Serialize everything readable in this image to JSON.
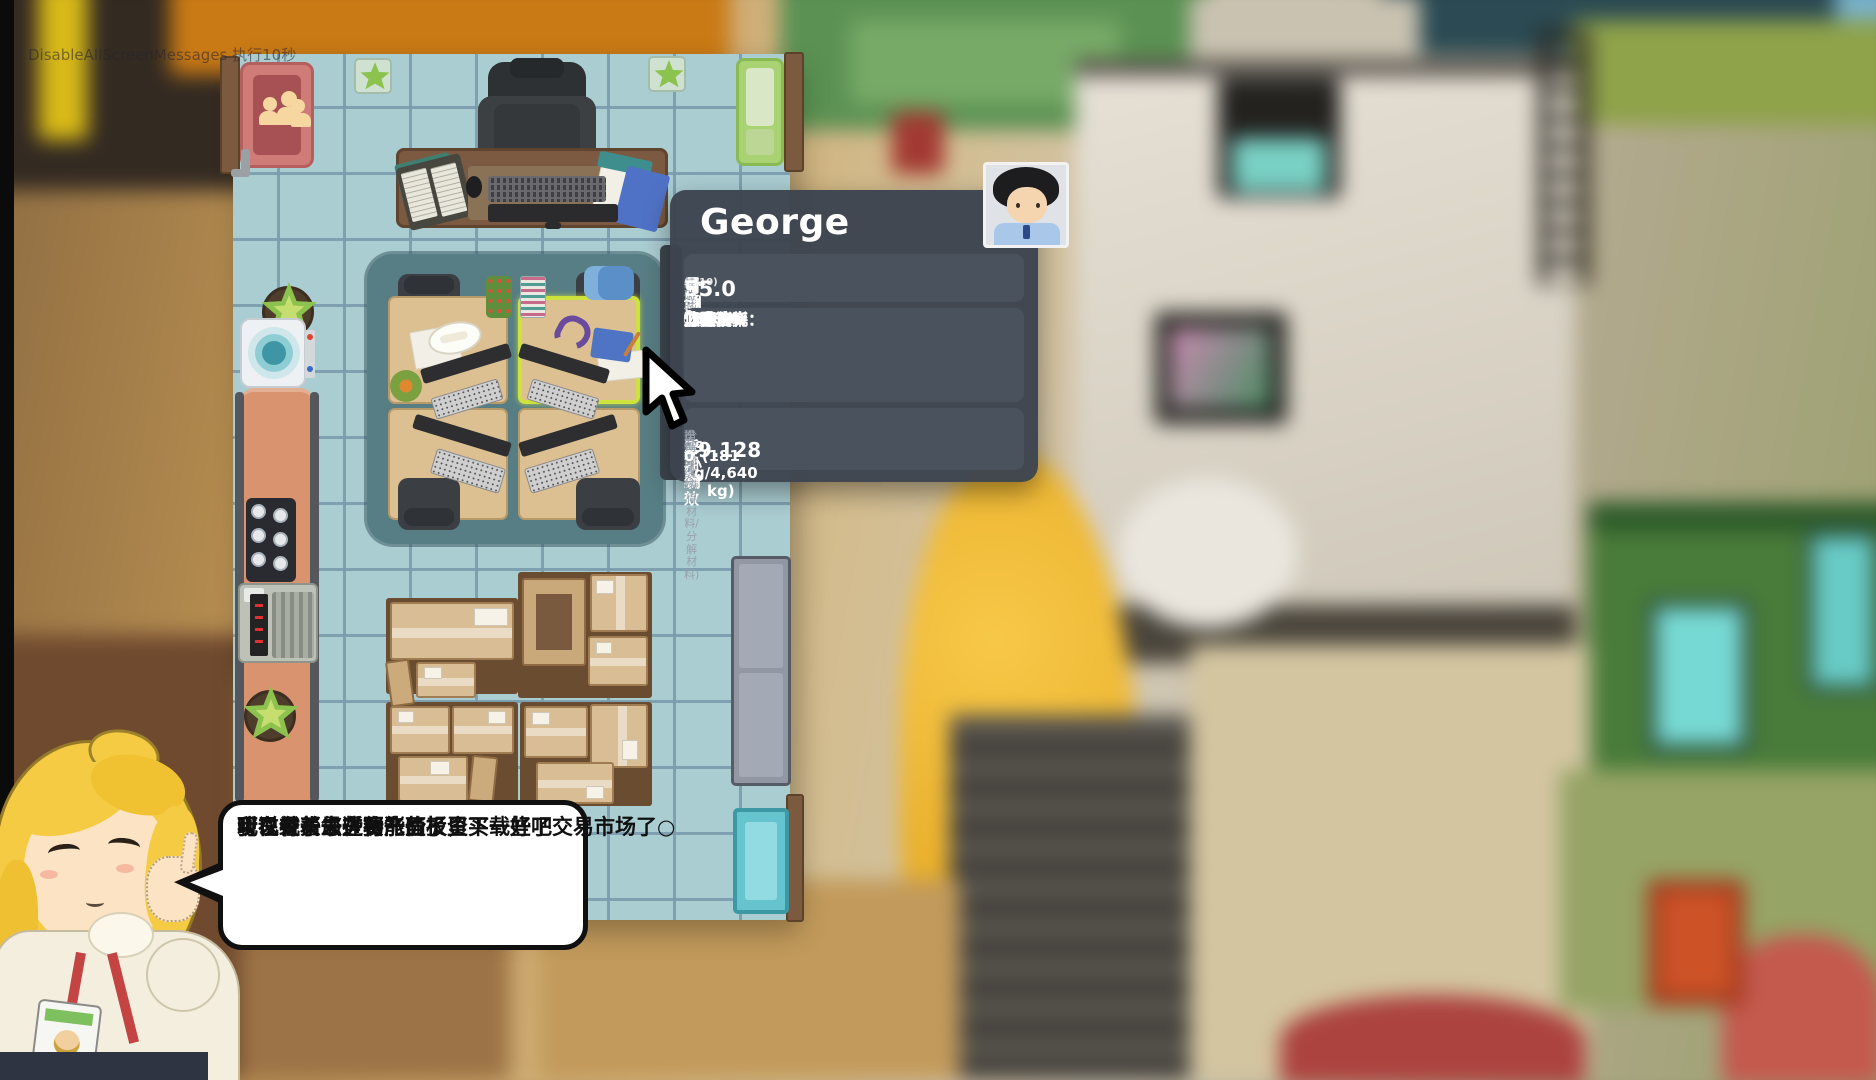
{
  "debug_text": "DisableAllScreenMessages 执行10秒",
  "character_panel": {
    "name": "George",
    "info": {
      "department_label": "部门",
      "department": "骨刨部",
      "level_label": "级别",
      "level": "普通员工",
      "level_progress": "(7/10)",
      "base_wage_label": "基础时薪",
      "base_wage": "55.0"
    },
    "stats": {
      "left": [
        {
          "icon": "luck-icon",
          "glyph": "♣",
          "label": "幸运：",
          "value": "15.0%"
        },
        {
          "icon": "favor-icon",
          "glyph": "♥",
          "label": "好感度：",
          "value": "5%"
        },
        {
          "icon": "overtime-pay-icon",
          "glyph": "♦",
          "label": "加班工资：",
          "value": "110.0"
        },
        {
          "icon": "exp-multiplier-icon",
          "glyph": "★",
          "label": "经验倍率：",
          "value": "7.2"
        }
      ],
      "right": [
        {
          "icon": "strength-icon",
          "glyph": "♠",
          "label": "力量：",
          "value": "80.0"
        },
        {
          "icon": "speed-icon",
          "glyph": "▶",
          "label": "速度：",
          "value": "8.0"
        },
        {
          "icon": "skill-icon",
          "glyph": "✓",
          "label": "技巧：",
          "value": "60.0%"
        },
        {
          "icon": "stamina-cost-icon",
          "glyph": "●",
          "label": "体力消耗：",
          "value": "10.0"
        }
      ]
    },
    "performance": {
      "recent_label": "近期绩效",
      "work_hours_label": "工作时长",
      "work_hours": "29 小时",
      "overall_label": "综合评分",
      "overall": "49.128",
      "slack_label": "摸鱼次数",
      "slack": "0",
      "decompose_label": "分解绩效(获得材料/分解材料)",
      "decompose": "(181 kg/4,640 kg)",
      "build_label": "建设实绩",
      "build": "0"
    }
  },
  "speech_bubble": {
    "lines": [
      "现在有了一些资产",
      "可以试着去进行一些投资",
      "听说骨头最近要涨价了，买一些吧",
      "我已经帮您在功能面板里下载好了交易市场了○"
    ]
  },
  "colors": {
    "panel_bg": "#3d444f",
    "panel_box": "#4a525d",
    "label_grey": "#98a1ab",
    "floor": "#aacdd2",
    "floor_grid": "#7a9bac",
    "work_mat": "#577e84",
    "desk": "#dcc091",
    "highlight": "#cde23c",
    "crate": "#d9bd94",
    "counter": "#d9946f",
    "teal_panel": "#66c4ce",
    "door_red": "#cf7b78",
    "door_green": "#a9d272",
    "bubble_border": "#101010"
  }
}
